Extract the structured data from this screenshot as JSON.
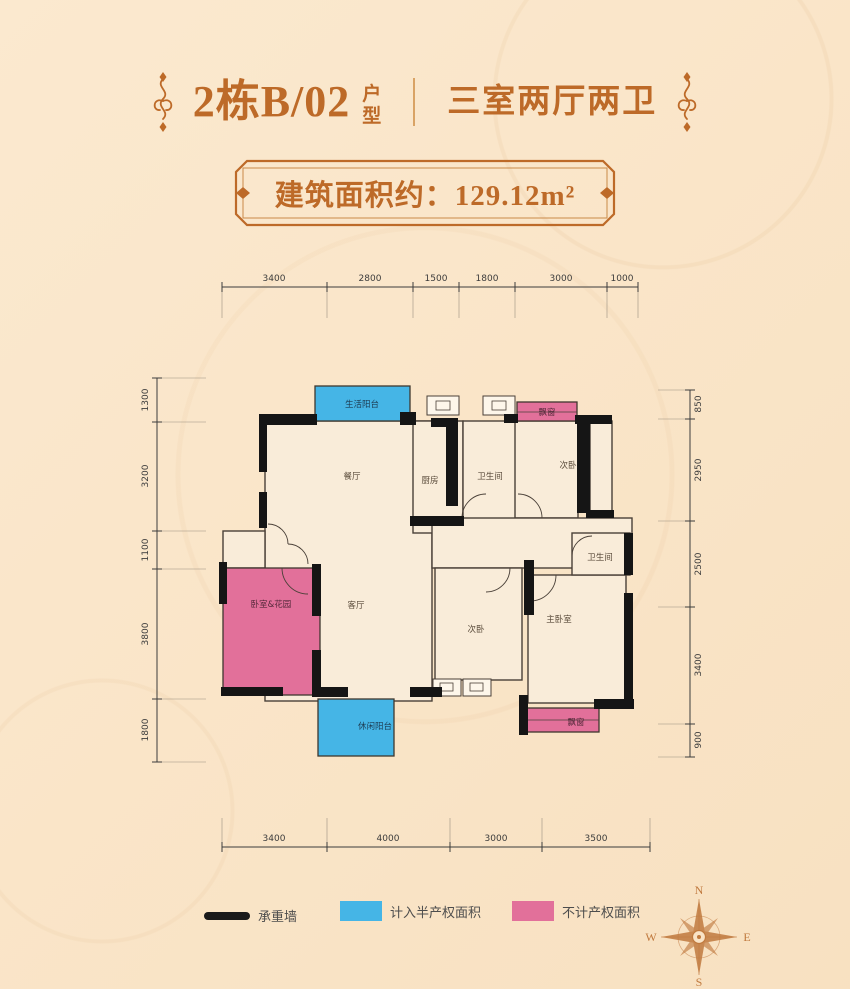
{
  "header": {
    "title_main": "2栋B/02",
    "title_vertical": [
      "户",
      "型"
    ],
    "title_right": "三室两厅两卫"
  },
  "badge": {
    "label": "建筑面积约：129.12m²"
  },
  "dims": {
    "top": [
      "3400",
      "2800",
      "1500",
      "1800",
      "3000",
      "1000"
    ],
    "bottom": [
      "3400",
      "4000",
      "3000",
      "3500"
    ],
    "left": [
      "1300",
      "3200",
      "1100",
      "3800",
      "1800"
    ],
    "right": [
      "850",
      "2950",
      "2500",
      "3400",
      "900"
    ]
  },
  "rooms": {
    "balcony_top": "生活阳台",
    "dining": "餐厅",
    "kitchen": "厨房",
    "bath_top": "卫生间",
    "bedroom_top": "次卧",
    "bay_top": "飘窗",
    "gift_room": "卧室&花园",
    "living": "客厅",
    "bedroom_mid": "次卧",
    "master": "主卧室",
    "bath_bottom": "卫生间",
    "balcony_bottom": "休闲阳台",
    "bay_bottom": "飘窗"
  },
  "legend": {
    "items": [
      {
        "label": "承重墙",
        "color": "#1a1a1a"
      },
      {
        "label": "计入半产权面积",
        "color": "#45b5e6"
      },
      {
        "label": "不计产权面积",
        "color": "#e2709a"
      }
    ]
  },
  "compass": {
    "north": "N",
    "south": "S",
    "east": "E",
    "west": "W"
  },
  "colors": {
    "accent": "#bd6a28",
    "background": "#f9e3c6",
    "wall": "#1a1a1a",
    "half_area": "#45b5e6",
    "no_area": "#e2709a"
  }
}
